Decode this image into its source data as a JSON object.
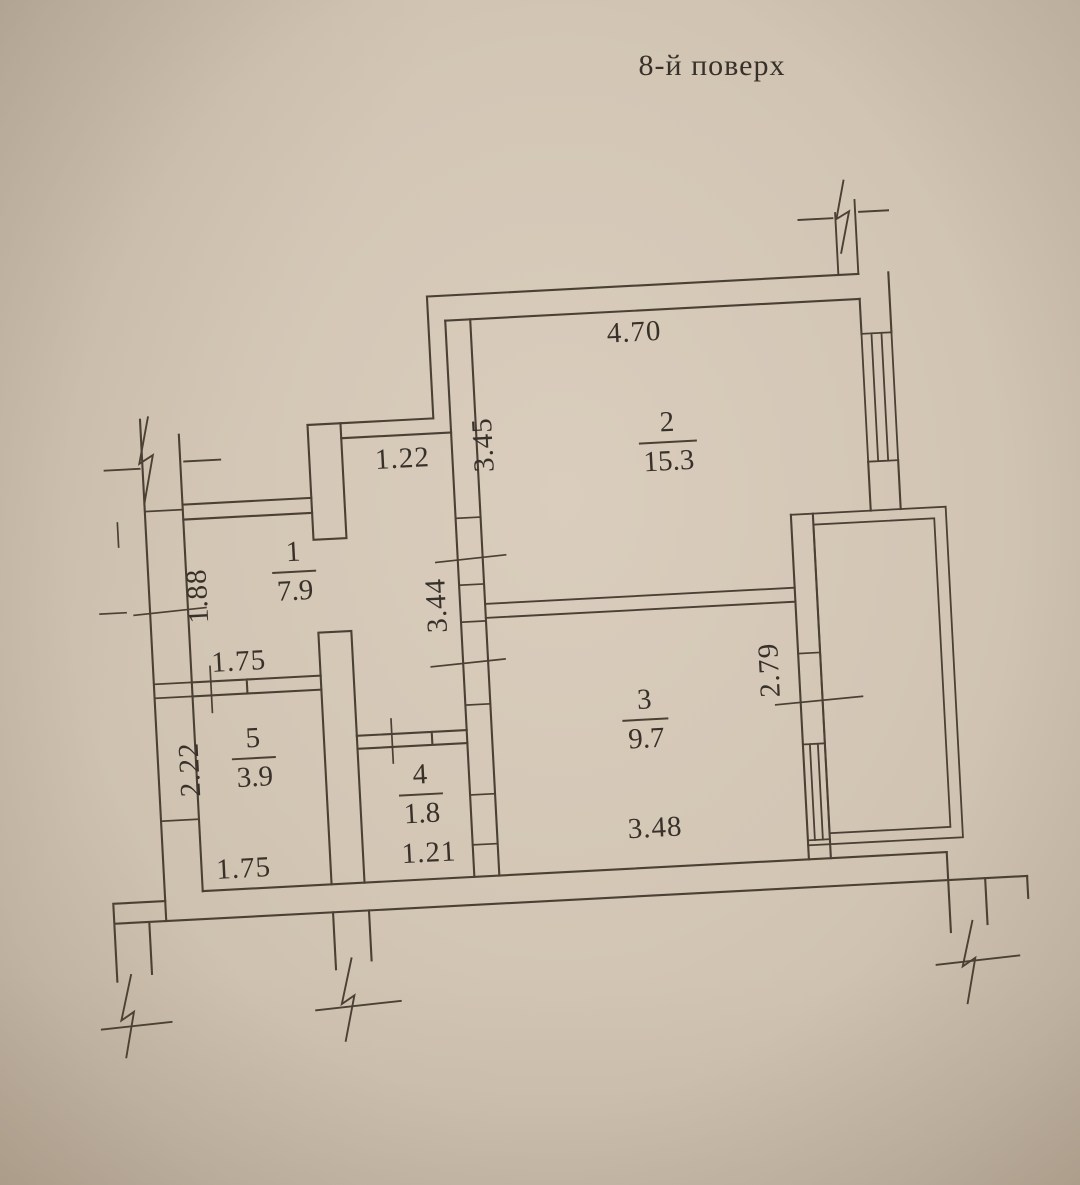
{
  "title": "8-й поверх",
  "rooms": [
    {
      "number": "1",
      "area": "7.9"
    },
    {
      "number": "2",
      "area": "15.3"
    },
    {
      "number": "3",
      "area": "9.7"
    },
    {
      "number": "4",
      "area": "1.8"
    },
    {
      "number": "5",
      "area": "3.9"
    }
  ],
  "dimensions": {
    "room2_width": "4.70",
    "room2_height": "3.45",
    "hall_opening_width": "1.22",
    "hall_left_height": "1.88",
    "hall_wall_height": "3.44",
    "room5_door_width": "1.75",
    "room5_height": "2.22",
    "room5_width": "1.75",
    "room4_width": "1.21",
    "room3_width": "3.48",
    "balcony_length": "2.79"
  },
  "colors": {
    "paper": "#d3c6b5",
    "ink": "#4a4034",
    "text": "#38312a"
  }
}
